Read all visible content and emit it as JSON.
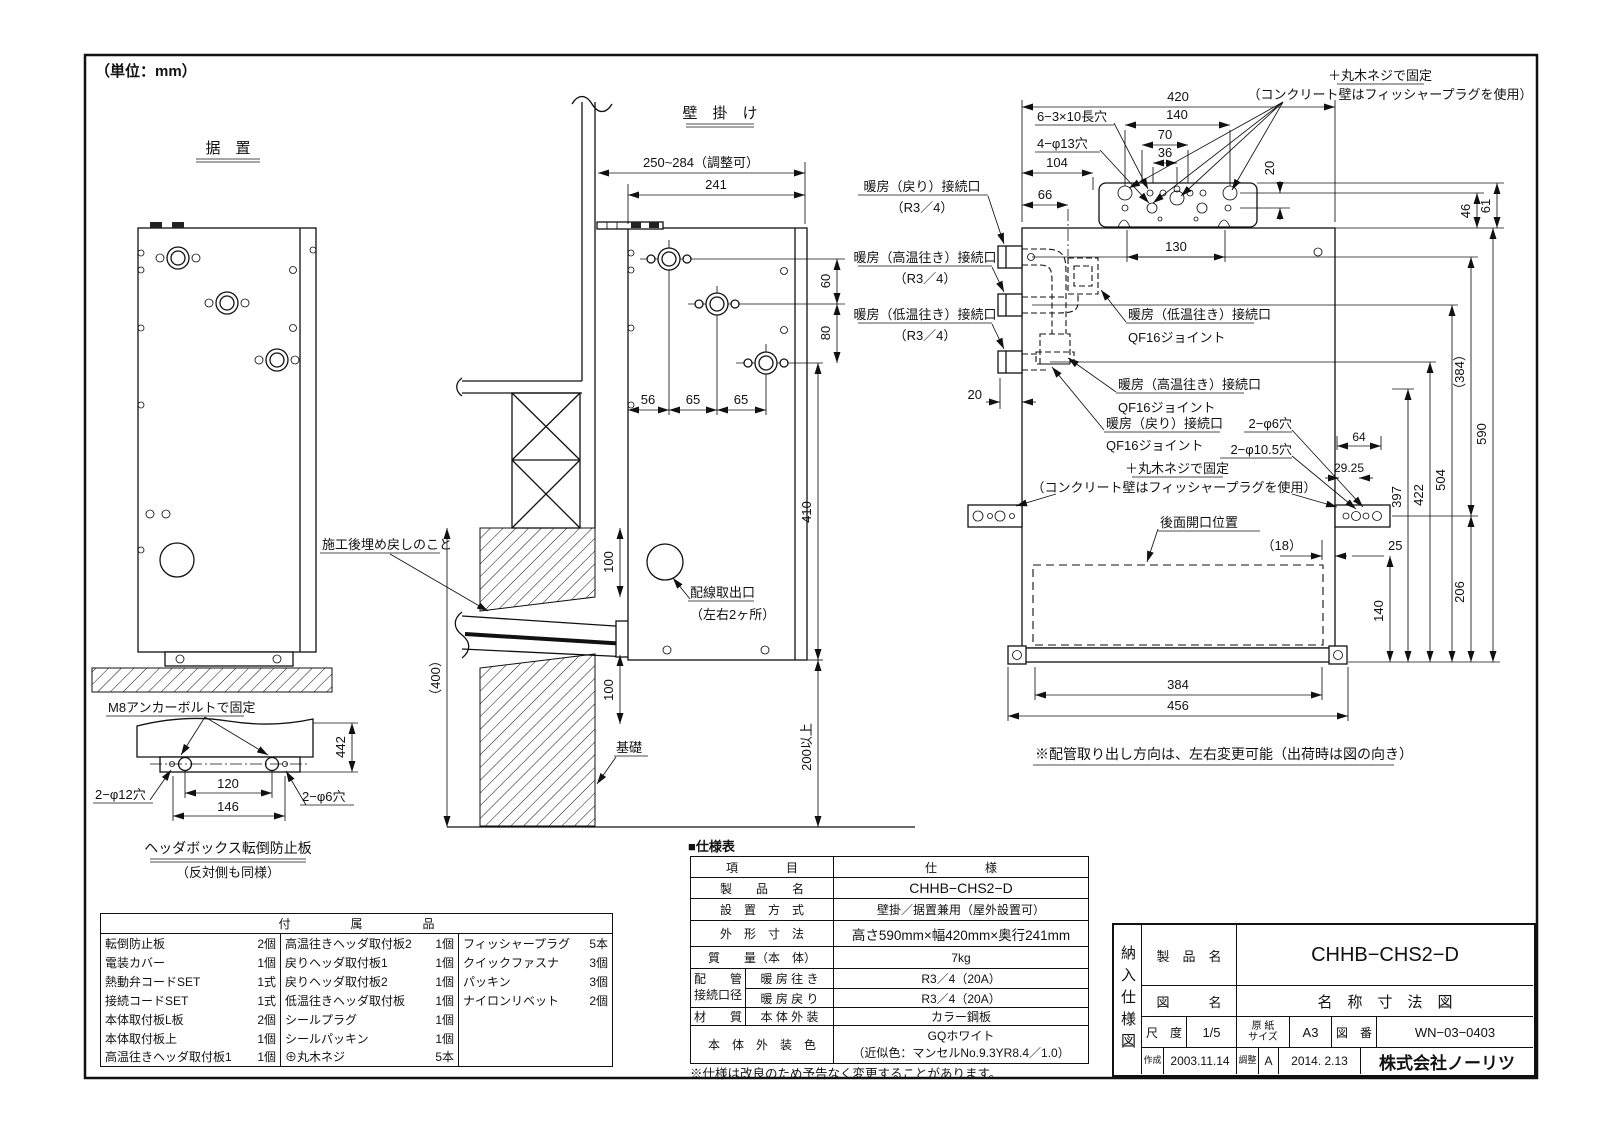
{
  "page": {
    "unit_note": "（単位：mm）"
  },
  "fig_sueoki": {
    "title": "据　置",
    "callout_m8": "M8アンカーボルトで固定",
    "dim_442": "442",
    "dim_120": "120",
    "dim_146": "146",
    "hole_left": "2−φ12穴",
    "hole_right": "2−φ6穴",
    "caption": "ヘッダボックス転倒防止板",
    "caption_sub": "（反対側も同様）"
  },
  "fig_kabekake": {
    "title": "壁　掛　け",
    "dim_range": "250~284（調整可）",
    "dim_241": "241",
    "dim_60": "60",
    "dim_80": "80",
    "dim_56": "56",
    "dim_65a": "65",
    "dim_65b": "65",
    "dim_410": "410",
    "dim_100a": "100",
    "dim_100b": "100",
    "dim_400": "（400）",
    "dim_200min": "200以上",
    "callout_backfill": "施工後埋め戻しのこと",
    "callout_wiring": "配線取出口",
    "callout_wiring_sub": "（左右2ヶ所）",
    "callout_foundation": "基礎"
  },
  "fig_rear": {
    "callout_screw_top1": "＋丸木ネジで固定",
    "callout_screw_top2": "（コンクリート壁はフィッシャープラグを使用）",
    "label_slot": "6−3×10長穴",
    "label_hole13": "4−φ13穴",
    "dim_420": "420",
    "dim_140t": "140",
    "dim_70": "70",
    "dim_36": "36",
    "dim_104": "104",
    "dim_66": "66",
    "dim_20t": "20",
    "dim_130": "130",
    "dim_46": "46",
    "dim_61": "61",
    "conn_return": "暖房（戻り）接続口",
    "conn_return_sub": "（R3／4）",
    "conn_hot": "暖房（高温往き）接続口",
    "conn_hot_sub": "（R3／4）",
    "conn_low": "暖房（低温往き）接続口",
    "conn_low_sub": "（R3／4）",
    "dim_20l": "20",
    "joint_low": "暖房（低温往き）接続口",
    "joint_low_sub": "QF16ジョイント",
    "joint_hot": "暖房（高温往き）接続口",
    "joint_hot_sub": "QF16ジョイント",
    "joint_return": "暖房（戻り）接続口",
    "joint_return_sub": "QF16ジョイント",
    "callout_screw_mid1": "＋丸木ネジで固定",
    "callout_screw_mid2": "（コンクリート壁はフィッシャープラグを使用）",
    "label_hole6": "2−φ6穴",
    "label_hole105": "2−φ10.5穴",
    "dim_64": "64",
    "dim_2925": "29.25",
    "label_rear_open": "後面開口位置",
    "dim_18": "（18）",
    "dim_25": "25",
    "dim_140r": "140",
    "dim_206": "206",
    "dim_397": "397",
    "dim_422": "422",
    "dim_504": "504",
    "dim_384p": "（384）",
    "dim_590": "590",
    "dim_384": "384",
    "dim_456": "456",
    "note": "※配管取り出し方向は、左右変更可能（出荷時は図の向き）"
  },
  "spec": {
    "title": "■仕様表",
    "header_item": "項　　　　目",
    "header_spec": "仕　　　　様",
    "product_label": "製　　品　　名",
    "product_value": "CHHB−CHS2−D",
    "install_label": "設　置　方　式",
    "install_value": "壁掛／据置兼用（屋外設置可）",
    "dims_label": "外　形　寸　法",
    "dims_value": "高さ590mm×幅420mm×奥行241mm",
    "weight_label": "質　　量（本　体）",
    "weight_value": "7kg",
    "pipe_label_1": "配　　管",
    "pipe_label_2": "接続口径",
    "pipe_out_label": "暖 房 往 き",
    "pipe_out_value": "R3／4（20A）",
    "pipe_ret_label": "暖 房 戻 り",
    "pipe_ret_value": "R3／4（20A）",
    "material_label": "材　　質",
    "material_sub": "本 体 外 装",
    "material_value": "カラー鋼板",
    "color_label": "本　体　外　装　色",
    "color_value_1": "GQホワイト",
    "color_value_2": "（近似色：マンセルNo.9.3YR8.4／1.0）",
    "note": "※仕様は改良のため予告なく変更することがあります。"
  },
  "parts": {
    "header": "付　　　　　属　　　　　品",
    "col1": [
      {
        "name": "転倒防止板",
        "qty": "2個"
      },
      {
        "name": "電装カバー",
        "qty": "1個"
      },
      {
        "name": "熱動弁コードSET",
        "qty": "1式"
      },
      {
        "name": "接続コードSET",
        "qty": "1式"
      },
      {
        "name": "本体取付板L板",
        "qty": "2個"
      },
      {
        "name": "本体取付板上",
        "qty": "1個"
      },
      {
        "name": "高温往きヘッダ取付板1",
        "qty": "1個"
      }
    ],
    "col2": [
      {
        "name": "高温往きヘッダ取付板2",
        "qty": "1個"
      },
      {
        "name": "戻りヘッダ取付板1",
        "qty": "1個"
      },
      {
        "name": "戻りヘッダ取付板2",
        "qty": "1個"
      },
      {
        "name": "低温往きヘッダ取付板",
        "qty": "1個"
      },
      {
        "name": "シールプラグ",
        "qty": "1個"
      },
      {
        "name": "シールパッキン",
        "qty": "1個"
      },
      {
        "name": "⊕丸木ネジ",
        "qty": "5本"
      }
    ],
    "col3": [
      {
        "name": "フィッシャープラグ",
        "qty": "5本"
      },
      {
        "name": "クイックファスナ",
        "qty": "3個"
      },
      {
        "name": "パッキン",
        "qty": "3個"
      },
      {
        "name": "ナイロンリベット",
        "qty": "2個"
      }
    ]
  },
  "titleblock": {
    "doc_type": "納入仕様図",
    "product_label": "製　品　名",
    "product_value": "CHHB−CHS2−D",
    "drawing_label": "図　　　名",
    "drawing_value": "名　称　寸　法　図",
    "scale_label": "尺　度",
    "scale_value": "1/5",
    "paper_label_1": "原 紙",
    "paper_label_2": "サイズ",
    "paper_value": "A3",
    "number_label": "図　番",
    "number_value": "WN−03−0403",
    "created_label": "作成",
    "created_value": "2003.11.14",
    "adjusted_label": "調整",
    "adjusted_rev": "A",
    "adjusted_value": "2014. 2.13",
    "company": "株式会社ノーリツ"
  }
}
